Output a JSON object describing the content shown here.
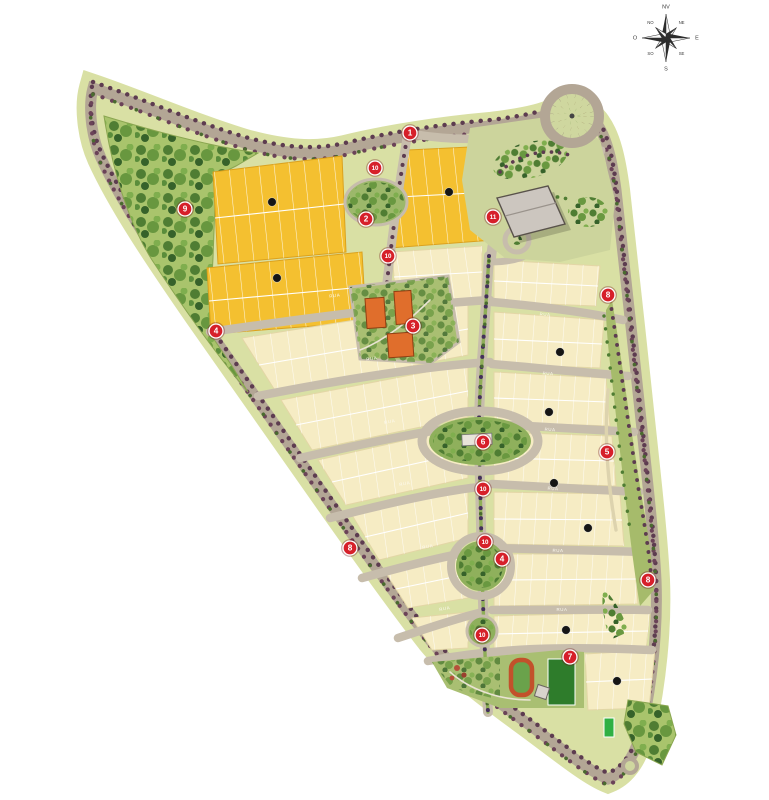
{
  "map": {
    "kind": "residential masterplan site plan",
    "background": "#ffffff"
  },
  "compass": {
    "labels": [
      "NV",
      "NE",
      "E",
      "SE",
      "S",
      "SO",
      "O",
      "NO"
    ]
  },
  "palette": {
    "land": "#d9e0a4",
    "road": "#b3a695",
    "road_minor": "#c7bdac",
    "lot_gold": "#f4c030",
    "lot_cream": "#f6ecc4",
    "tree_row": "#5d3c50",
    "forest_green": "#4f7d33",
    "park_green": "#8fb05c",
    "building_orange": "#e06e2c",
    "building_gray": "#ccc6bf",
    "marker_red": "#d6202a",
    "badge_black": "#151515",
    "sports_field": "#2e7c2b",
    "court_green": "#2fb043",
    "track_red": "#c2512b"
  },
  "markers": [
    {
      "label": "1",
      "x": 410,
      "y": 133
    },
    {
      "label": "10",
      "x": 375,
      "y": 168
    },
    {
      "label": "2",
      "x": 366,
      "y": 219
    },
    {
      "label": "9",
      "x": 185,
      "y": 209
    },
    {
      "label": "10",
      "x": 388,
      "y": 256
    },
    {
      "label": "11",
      "x": 493,
      "y": 217
    },
    {
      "label": "8",
      "x": 608,
      "y": 295
    },
    {
      "label": "4",
      "x": 216,
      "y": 331
    },
    {
      "label": "3",
      "x": 413,
      "y": 326
    },
    {
      "label": "6",
      "x": 483,
      "y": 442
    },
    {
      "label": "5",
      "x": 607,
      "y": 452
    },
    {
      "label": "10",
      "x": 483,
      "y": 489
    },
    {
      "label": "10",
      "x": 485,
      "y": 542
    },
    {
      "label": "4",
      "x": 502,
      "y": 559
    },
    {
      "label": "8",
      "x": 350,
      "y": 548
    },
    {
      "label": "8",
      "x": 648,
      "y": 580
    },
    {
      "label": "10",
      "x": 482,
      "y": 635
    },
    {
      "label": "7",
      "x": 570,
      "y": 657
    }
  ],
  "block_badges": [
    {
      "x": 272,
      "y": 202
    },
    {
      "x": 449,
      "y": 192
    },
    {
      "x": 277,
      "y": 278
    },
    {
      "x": 560,
      "y": 352
    },
    {
      "x": 549,
      "y": 412
    },
    {
      "x": 554,
      "y": 483
    },
    {
      "x": 588,
      "y": 528
    },
    {
      "x": 566,
      "y": 630
    },
    {
      "x": 617,
      "y": 681
    }
  ],
  "street_labels": [
    {
      "text": "RUA",
      "x": 335,
      "y": 297,
      "rot": -8
    },
    {
      "text": "RUA",
      "x": 372,
      "y": 360,
      "rot": -9
    },
    {
      "text": "RUA",
      "x": 390,
      "y": 423,
      "rot": -10
    },
    {
      "text": "RUA",
      "x": 405,
      "y": 485,
      "rot": -10
    },
    {
      "text": "RUA",
      "x": 428,
      "y": 548,
      "rot": -10
    },
    {
      "text": "RUA",
      "x": 445,
      "y": 610,
      "rot": -10
    },
    {
      "text": "RUA",
      "x": 545,
      "y": 316,
      "rot": 4
    },
    {
      "text": "RUA",
      "x": 548,
      "y": 375,
      "rot": 3
    },
    {
      "text": "RUA",
      "x": 550,
      "y": 431,
      "rot": 3
    },
    {
      "text": "RUA",
      "x": 553,
      "y": 490,
      "rot": 2
    },
    {
      "text": "RUA",
      "x": 558,
      "y": 552,
      "rot": 1
    },
    {
      "text": "RUA",
      "x": 562,
      "y": 611,
      "rot": 0
    }
  ]
}
